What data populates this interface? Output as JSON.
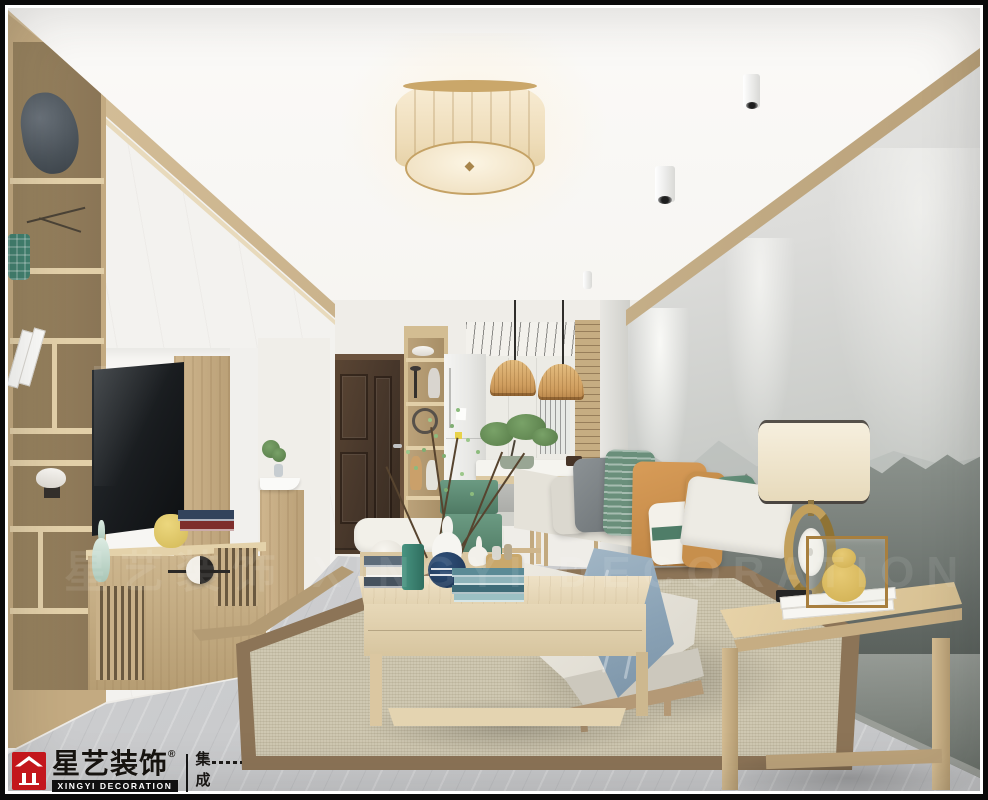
{
  "branding": {
    "logo_cn": "星艺装饰",
    "logo_reg": "®",
    "logo_en": "XINGYI DECORATION",
    "logo_unit_top": "集",
    "logo_unit_bottom": "成",
    "brand_red": "#c3161c"
  },
  "watermark": {
    "text": "星艺装饰 XINGYI DECORATION"
  },
  "palette": {
    "wood": "#c9b189",
    "wood_trim": "#b59c74",
    "white_cabinet": "#f3f2ef",
    "wall_gray": "#cfd1cd",
    "marble": "#d0d1d3",
    "rug": "#cfc8b2",
    "rug_border": "#8c7457",
    "accent_orange": "#cc9050",
    "accent_green": "#5d8671",
    "accent_navy": "#1f3a5c",
    "accent_teal": "#3f8e7d",
    "blanket_blue": "#8ba3b6",
    "door_brown": "#46362a",
    "lamp_cream": "#f1e2c4"
  }
}
